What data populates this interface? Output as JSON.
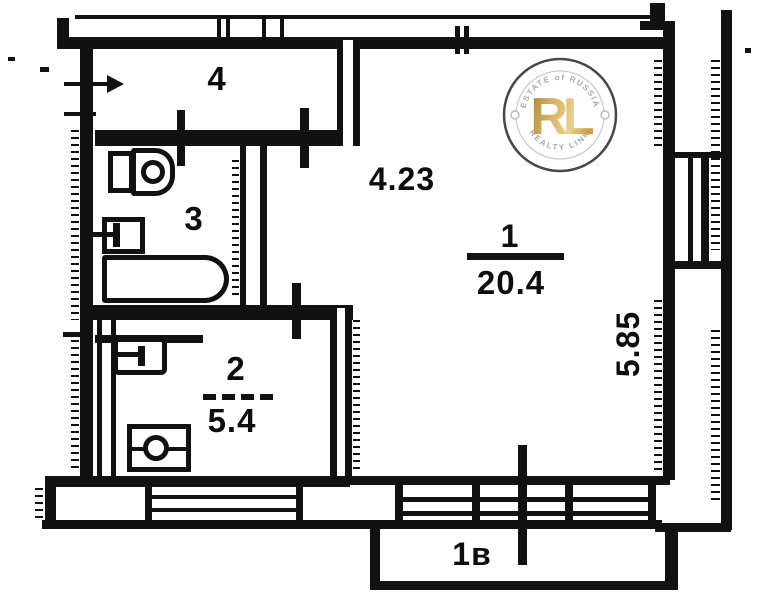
{
  "plan": {
    "rooms": {
      "living": {
        "number": "1",
        "area": "20.4"
      },
      "kitchen": {
        "number": "2",
        "area": "5.4"
      },
      "bathroom": {
        "number": "3"
      },
      "hallway": {
        "number": "4"
      }
    },
    "dimensions": {
      "width_m": "4.23",
      "depth_m": "5.85"
    },
    "balcony": {
      "label": "1в"
    }
  },
  "watermark": {
    "arc_top": "ESTATE of RUSSIA",
    "monogram": "RL",
    "arc_bottom": "REALTY LINK",
    "gold_color": "#c49b4a",
    "ring_color": "#b8b8b8",
    "ink_color": "#3a3a3a"
  },
  "colors": {
    "ink": "#111111",
    "paper": "#ffffff"
  }
}
